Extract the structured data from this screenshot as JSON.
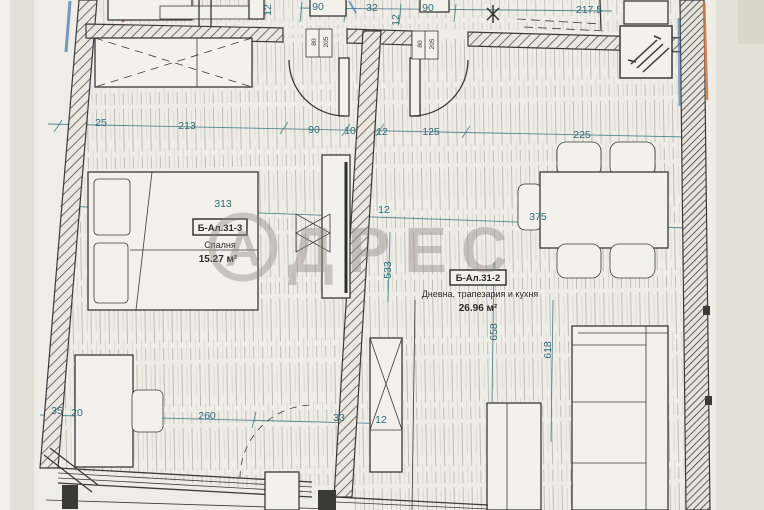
{
  "watermark": {
    "circle_letter": "А",
    "brand": "ДРЕС"
  },
  "rooms": [
    {
      "code": "Б-Ал.31-3",
      "name": "Спалня",
      "area": "15.27 м²"
    },
    {
      "code": "Б-Ал.31-2",
      "name": "Дневна, трапезария и кухня",
      "area": "26.96 м²"
    }
  ],
  "door_size_tags": [
    {
      "w": "80",
      "h": "205"
    },
    {
      "w": "80",
      "h": "205"
    }
  ],
  "dim_labels": [
    {
      "t": "90",
      "x": 318,
      "y": 10
    },
    {
      "t": "32",
      "x": 372,
      "y": 11
    },
    {
      "t": "90",
      "x": 428,
      "y": 11
    },
    {
      "t": "12",
      "x": 399,
      "y": 20,
      "r": -90
    },
    {
      "t": "12",
      "x": 271,
      "y": 10,
      "r": -90
    },
    {
      "t": "217.5",
      "x": 589,
      "y": 13
    },
    {
      "t": "25",
      "x": 101,
      "y": 126
    },
    {
      "t": "213",
      "x": 187,
      "y": 129
    },
    {
      "t": "90",
      "x": 314,
      "y": 133
    },
    {
      "t": "10",
      "x": 350,
      "y": 134
    },
    {
      "t": "12",
      "x": 382,
      "y": 135
    },
    {
      "t": "125",
      "x": 431,
      "y": 135
    },
    {
      "t": "225",
      "x": 582,
      "y": 138
    },
    {
      "t": "313",
      "x": 223,
      "y": 207
    },
    {
      "t": "12",
      "x": 384,
      "y": 213
    },
    {
      "t": "375",
      "x": 538,
      "y": 220
    },
    {
      "t": "533",
      "x": 391,
      "y": 270,
      "r": -90
    },
    {
      "t": "658",
      "x": 497,
      "y": 332,
      "r": -90
    },
    {
      "t": "618",
      "x": 551,
      "y": 350,
      "r": -90
    },
    {
      "t": "35",
      "x": 57,
      "y": 414
    },
    {
      "t": "20",
      "x": 77,
      "y": 416
    },
    {
      "t": "260",
      "x": 207,
      "y": 419
    },
    {
      "t": "33",
      "x": 339,
      "y": 421
    },
    {
      "t": "12",
      "x": 381,
      "y": 423
    }
  ],
  "colors": {
    "paper": "#efede8",
    "ink": "#3a3a38",
    "dimension_teal": "#2f6b76",
    "watermark_gray": "#8d8880",
    "accent_orange": "#cc7a4e",
    "pen_blue": "#4a7fae",
    "pen_red": "#a1402e"
  }
}
